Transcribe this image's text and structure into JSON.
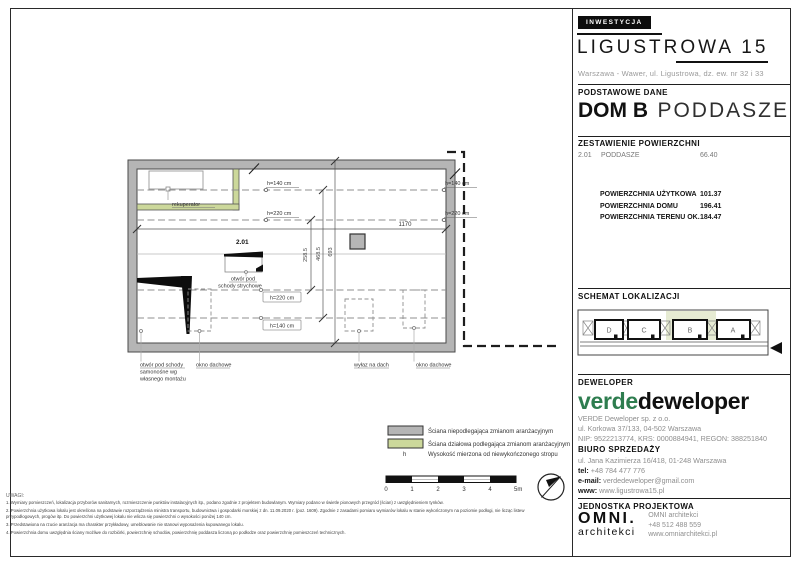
{
  "header": {
    "tag": "INWESTYCJA",
    "project": "LIGUSTROWA 15",
    "address": "Warszawa - Wawer, ul. Ligustrowa, dz. ew. nr 32 i 33",
    "section_basic": "PODSTAWOWE DANE",
    "house": "DOM B",
    "level": "PODDASZE"
  },
  "areas": {
    "section": "ZESTAWIENIE POWIERZCHNI",
    "rows": [
      {
        "no": "2.01",
        "name": "PODDASZE",
        "value": "66.40"
      }
    ],
    "summary": [
      {
        "label": "POWIERZCHNIA UŻYTKOWA",
        "value": "101.37"
      },
      {
        "label": "POWIERZCHNIA DOMU",
        "value": "196.41"
      },
      {
        "label": "POWIERZCHNIA TERENU OK.",
        "value": "184.47"
      }
    ]
  },
  "location": {
    "section": "SCHEMAT LOKALIZACJI",
    "units": [
      "D",
      "C",
      "B",
      "A"
    ],
    "highlighted": "B"
  },
  "developer": {
    "section": "DEWELOPER",
    "logo_green": "verde",
    "logo_black": "deweloper",
    "lines": [
      "VERDE Deweloper sp. z o.o.",
      "ul. Korkowa 37/133, 04-502 Warszawa",
      "NIP: 9522213774, KRS: 0000884941, REGON: 388251840"
    ]
  },
  "sales": {
    "section": "BIURO SPRZEDAŻY",
    "address": "ul. Jana Kazimierza 16/418, 01-248 Warszawa",
    "tel_label": "tel:",
    "tel": "+48 784 477 776",
    "email_label": "e-mail:",
    "email": "verdedeweloper@gmail.com",
    "www_label": "www:",
    "www": "www.ligustrowa15.pl"
  },
  "design": {
    "section": "JEDNOSTKA PROJEKTOWA",
    "logo_top": "OMNI.",
    "logo_bottom": "architekci",
    "lines": [
      "OMNI architekci",
      "+48 512 488 559",
      "www.omniarchitekci.pl"
    ]
  },
  "plan": {
    "room": "2.01",
    "h140": "h=140 cm",
    "h220": "h=220 cm",
    "width_dim": "1170",
    "v_dims": [
      "258.5",
      "468.5",
      "693"
    ],
    "rekuperator": "rekuperator",
    "attic_hatch_line1": "otwór pod",
    "attic_hatch_line2": "schody strychowe",
    "stairs_label": [
      "otwór pod schody",
      "samonośne wg",
      "własnego montażu"
    ],
    "roof_window": "okno dachowe",
    "roof_hatch": "wyłaz na dach"
  },
  "legend": {
    "wall_fixed": "Ściana niepodlegająca zmianom aranżacyjnym",
    "wall_partition": "Ściana działowa podlegająca zmianom aranżacyjnym",
    "h_symbol": "h",
    "h_desc": "Wysokość mierzona od niewykończonego stropu"
  },
  "scalebar": {
    "ticks": [
      "0",
      "1",
      "2",
      "3",
      "4",
      "5m"
    ]
  },
  "notes": {
    "title": "UWAGI:",
    "items": [
      "1. Wymiary pomieszczeń, lokalizacja przyborów sanitarnych, rozmieszczenie punktów instalacyjnych itp., podano zgodnie z projektem budowlanym. Wymiary podano w świetle pionowych przegród (ścian) z uwzględnieniem tynków.",
      "2. Powierzchnia użytkowa lokalu jest określona na podstawie rozporządzenia ministra transportu, budownictwa i gospodarki morskiej z dn. 11.09.2020 r. (poz. 1609). Zgodnie z zasadami pomiaru wymiarów lokalu w stanie wykończonym na poziomie podłogi, nie licząc listew przypodłogowych, progów itp. Do powierzchni użytkowej lokalu nie wlicza się powierzchni o wysokości poniżej 140 cm.",
      "3. Przedstawiona na rzucie aranżacja ma charakter przykładowy, umeblowanie nie stanowi wyposażenia kupowanego lokalu.",
      "4. Powierzchnia domu uwzględnia ściany możliwe do rozbiórki, powierzchnię schodów, powierzchnię poddasza liczoną po podłodze oraz powierzchnię pomieszczeń technicznych."
    ]
  },
  "colors": {
    "wall_gray": "#b5b5b5",
    "wall_green": "#ccd89b",
    "highlight_green": "#e6ebd3",
    "brand_green": "#2e7d4f"
  }
}
